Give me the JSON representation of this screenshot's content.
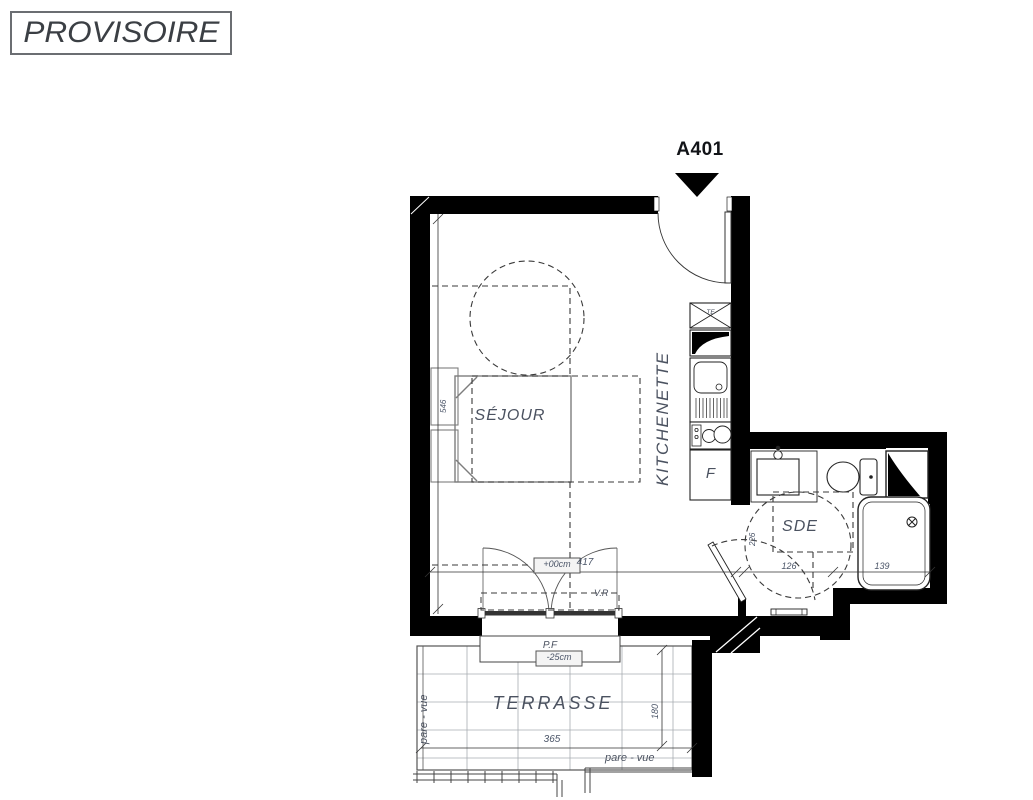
{
  "stamp": {
    "label": "PROVISOIRE"
  },
  "unit": {
    "label": "A401"
  },
  "rooms": {
    "sejour": "SÉJOUR",
    "kitchenette": "KITCHENETTE",
    "sde": "SDE",
    "terrasse": "TERRASSE"
  },
  "appliances": {
    "fridge_label": "F",
    "vent_label": "TE"
  },
  "levels": {
    "sejour_level": "+00cm",
    "terrasse_level": "-25cm"
  },
  "openings": {
    "roller_shutter": "V.R",
    "french_window": "P.F"
  },
  "screens": {
    "left": "pare - vue",
    "bottom": "pare - vue"
  },
  "dimensions": {
    "sejour_depth": "546",
    "sejour_width": "417",
    "sde_width": "126",
    "shower_width": "139",
    "sde_depth": "226",
    "terrasse_width": "365",
    "terrasse_depth": "180"
  },
  "colors": {
    "wall": "#000000",
    "room_label": "#4b5260",
    "dimension_label": "#4b5568",
    "stamp_text": "#3b3f44"
  }
}
